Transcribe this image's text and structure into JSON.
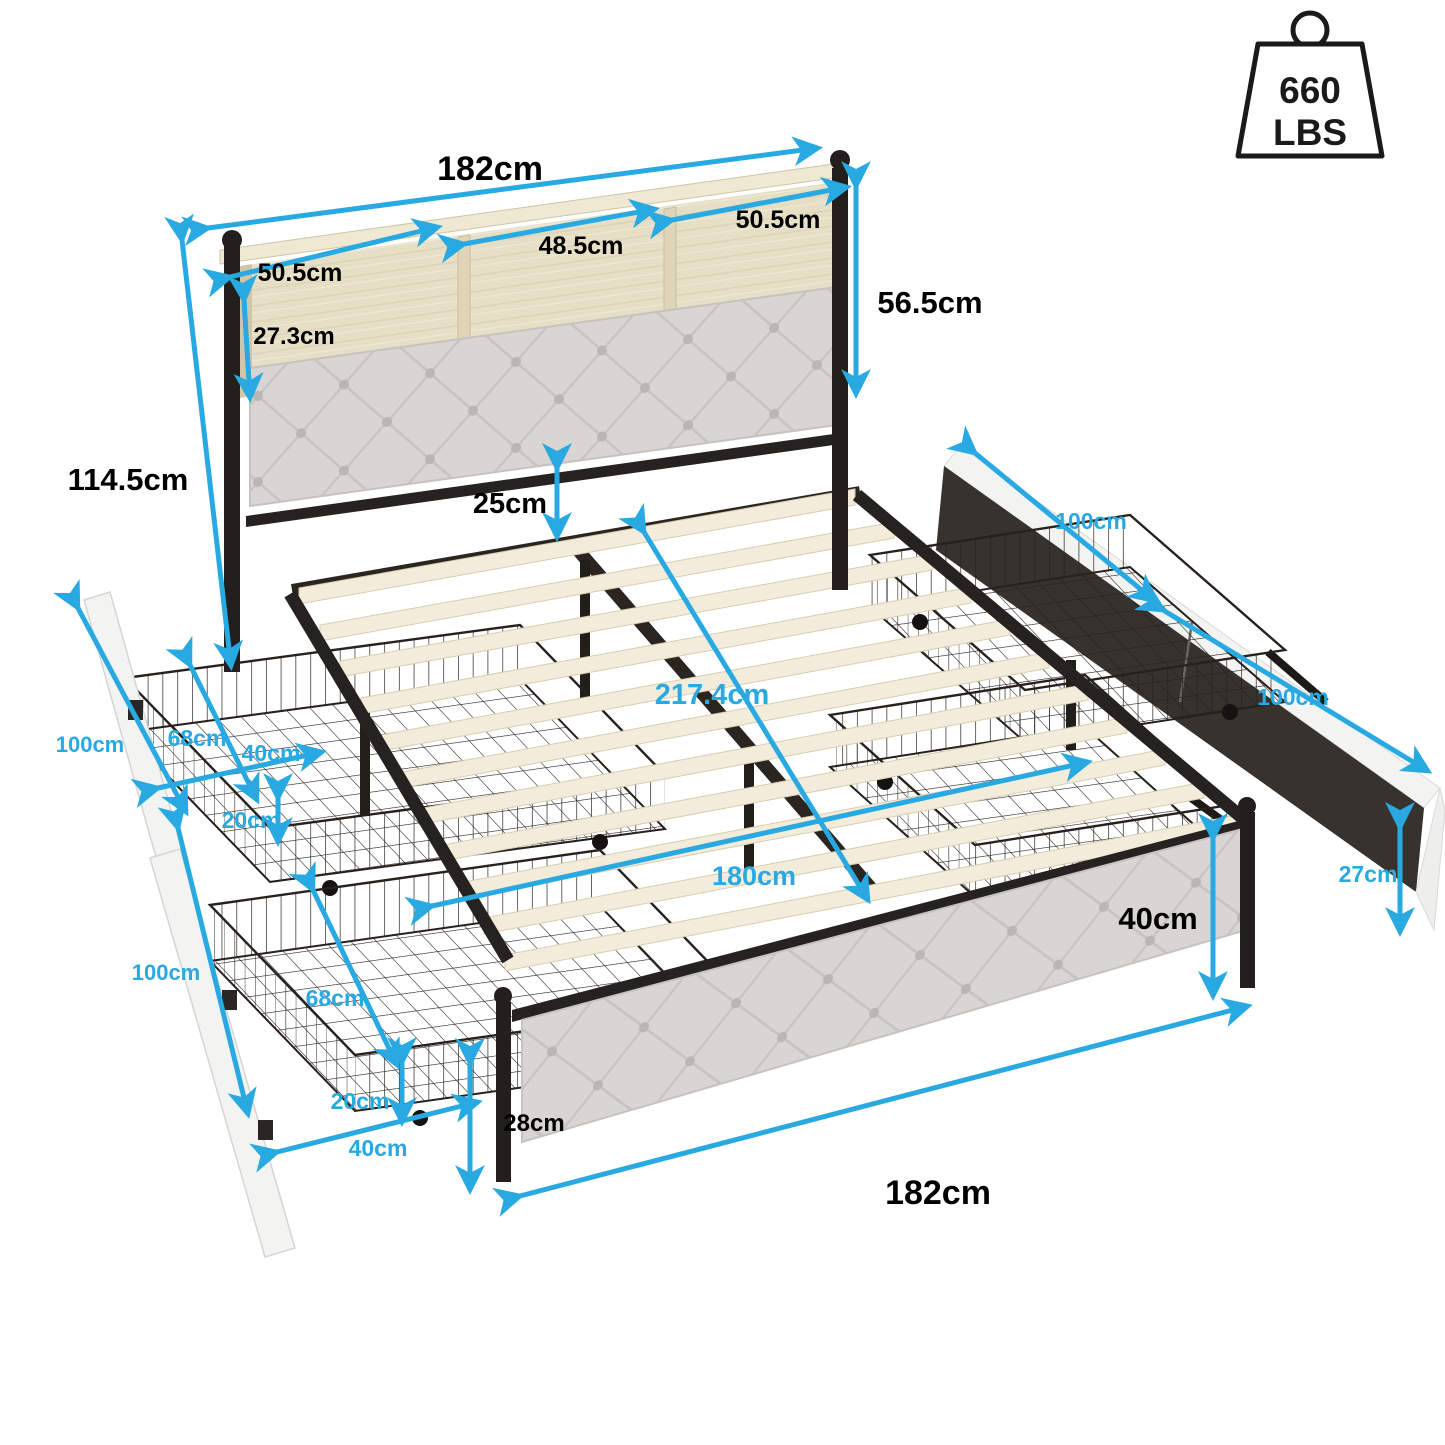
{
  "badge": {
    "icon": "weight-capacity-icon",
    "value": "660",
    "unit": "LBS"
  },
  "dims": {
    "headboard_width": "182cm",
    "shelf_left": "50.5cm",
    "shelf_center": "48.5cm",
    "shelf_right": "50.5cm",
    "shelf_depth": "27.3cm",
    "headboard_upper_height": "56.5cm",
    "headboard_total_height": "114.5cm",
    "under_headboard_gap": "25cm",
    "bed_length": "217.4cm",
    "slat_width": "180cm",
    "right_drawer_near_length": "100cm",
    "right_drawer_far_length": "100cm",
    "left_drawer_upper_length": "100cm",
    "left_drawer_lower_length": "100cm",
    "left_upper_drawer_depth": "68cm",
    "left_upper_drawer_width": "40cm",
    "left_upper_drawer_height": "20cm",
    "left_lower_drawer_depth": "68cm",
    "left_lower_drawer_height": "20cm",
    "left_lower_drawer_width": "40cm",
    "footboard_height": "40cm",
    "floor_clearance": "28cm",
    "footboard_width": "182cm",
    "drawer_front_height": "27cm"
  },
  "colors": {
    "accent": "#29a9e1",
    "label": "#000000",
    "metal": "#262220",
    "wood_shelf": "#e6dfc6",
    "slat": "#f3ecda",
    "cushion": "#d8d5d3",
    "panel_white": "#f3f3f1",
    "panel_dark": "#37322e"
  }
}
